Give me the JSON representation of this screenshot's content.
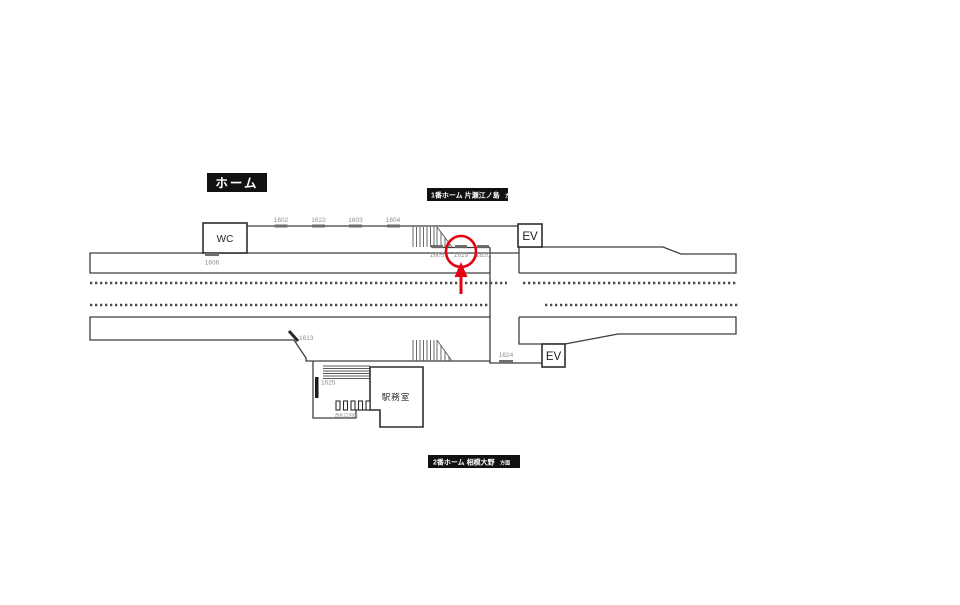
{
  "legend": {
    "title": "ホーム"
  },
  "platform1_badge": {
    "text": "1番ホーム 片瀬江ノ島",
    "suffix": "方面"
  },
  "platform2_badge": {
    "text": "2番ホーム 相模大野",
    "suffix": "方面"
  },
  "facilities": {
    "wc": "WC",
    "ev_upper": "EV",
    "ev_lower": "EV",
    "office": "駅務室",
    "gate_area_note": "改札口内側"
  },
  "positions": {
    "top": [
      "1602",
      "1622",
      "1603",
      "1604"
    ],
    "wc_side": "1606",
    "center": [
      "1605",
      "1619",
      "1620"
    ],
    "lower_left": "1613",
    "stair": "1625",
    "lower_walkway": "1624"
  },
  "highlight": {
    "target": "1619",
    "color": "#e60012"
  },
  "colors": {
    "accent_red": "#e60012",
    "line": "#3d3d3d",
    "badge_bg": "#111111",
    "position_text": "#8f8f8f"
  }
}
